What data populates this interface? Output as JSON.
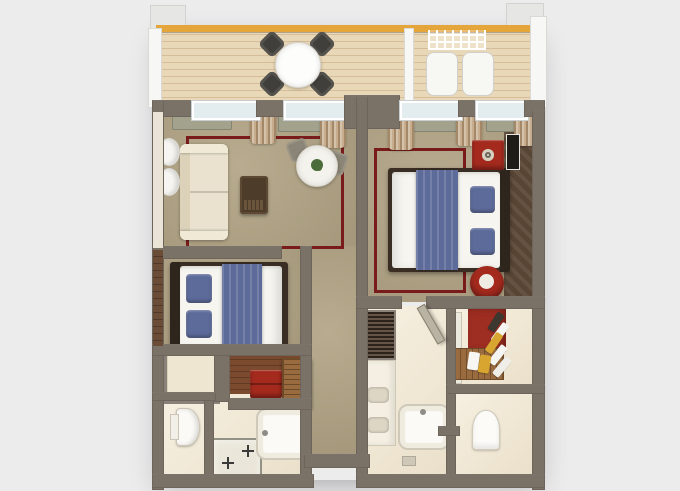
{
  "scene": {
    "type": "3d-floor-plan-rendering",
    "view": "top-down axonometric",
    "units": [
      {
        "name": "left-suite",
        "rooms": [
          "living-room",
          "bedroom",
          "dressing-nook",
          "bathroom",
          "toilet-compartment"
        ],
        "furniture": [
          "sofa",
          "ottoman-coffee-table",
          "breakfast-table",
          "dining-chairs",
          "pouf-chairs",
          "double-bed",
          "wardrobe",
          "red-bench",
          "luggage-desk",
          "toilet",
          "shower",
          "bathtub"
        ]
      },
      {
        "name": "right-suite",
        "rooms": [
          "bedroom",
          "bathroom",
          "walk-in-closet",
          "toilet-room",
          "wet-room",
          "entry-vestibule"
        ],
        "furniture": [
          "king-bed",
          "red-nightstand",
          "red-side-table",
          "louvered-cabinet",
          "vanity-with-sinks",
          "bathtub",
          "toilet",
          "closet-bench",
          "hanging-clothes"
        ]
      },
      {
        "name": "shared-balcony",
        "furniture": [
          "outdoor-round-table",
          "outdoor-chairs",
          "lounge-chairs",
          "pergola-trellis"
        ]
      }
    ]
  },
  "palette": {
    "bg": "#ececed",
    "wall": "#7a7167",
    "wallLight": "#8e857b",
    "deck": "#e9d8b7",
    "deckLine": "#d5bd99",
    "gold": "#e4a53b",
    "carpet": "#b2a485",
    "rug": "#7a1b1b",
    "bathFloor": "#f3e8d1",
    "wood": "#7c4a2e",
    "blue": "#5d6b9a",
    "red": "#a52a1e",
    "sofa": "#eae2cf",
    "bedWhite": "#f7f5f0",
    "headboard": "#3a2e24",
    "sage": "#a2a28d",
    "curtain": "#c7ad8d",
    "glass": "#e3ecee",
    "louver": "#4f3d2f",
    "panel": "#584534",
    "closetWood": "#9a6b3e",
    "yellow": "#d8a630"
  }
}
